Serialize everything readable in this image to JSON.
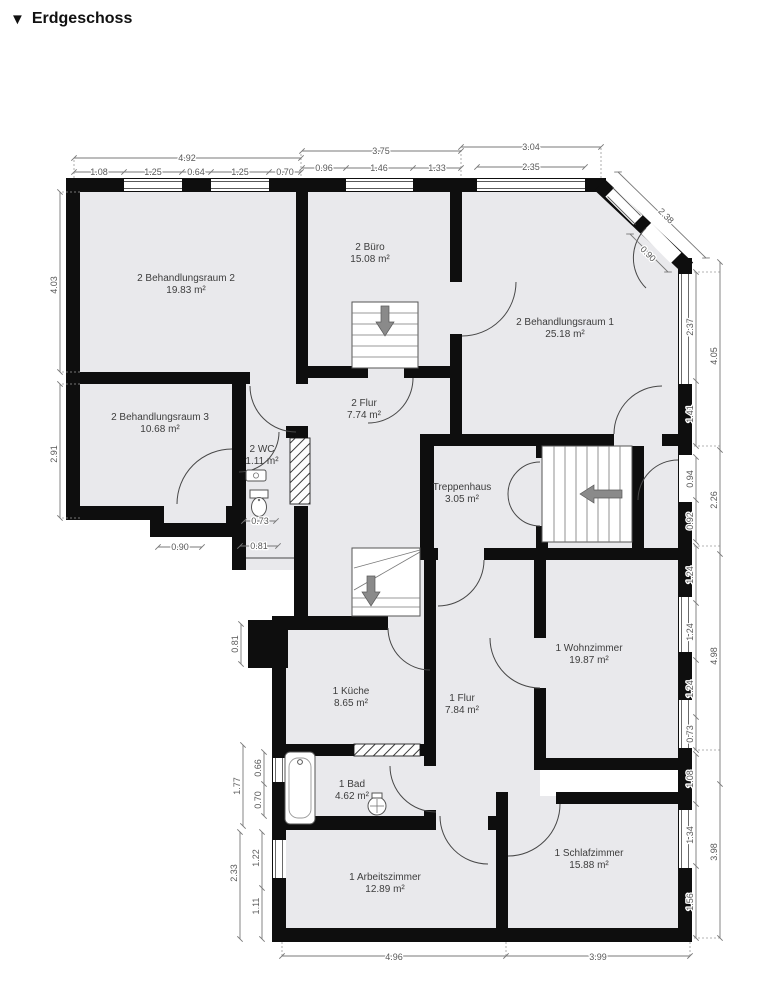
{
  "header": {
    "collapse_marker": "▼",
    "title": "Erdgeschoss"
  },
  "rooms": [
    {
      "label": "2 Behandlungsraum 2",
      "area": "19.83 m²"
    },
    {
      "label": "2 Büro",
      "area": "15.08 m²"
    },
    {
      "label": "2 Behandlungsraum 1",
      "area": "25.18 m²"
    },
    {
      "label": "2 Behandlungsraum 3",
      "area": "10.68 m²"
    },
    {
      "label": "2 Flur",
      "area": "7.74 m²"
    },
    {
      "label": "2 WC",
      "area": "1.11 m²"
    },
    {
      "label": "Treppenhaus",
      "area": "3.05 m²"
    },
    {
      "label": "1 Wohnzimmer",
      "area": "19.87 m²"
    },
    {
      "label": "1 Küche",
      "area": "8.65 m²"
    },
    {
      "label": "1 Flur",
      "area": "7.84 m²"
    },
    {
      "label": "1 Bad",
      "area": "4.62 m²"
    },
    {
      "label": "1 Arbeitszimmer",
      "area": "12.89 m²"
    },
    {
      "label": "1 Schlafzimmer",
      "area": "15.88 m²"
    }
  ],
  "dims": {
    "top": [
      "4.92",
      "1.08",
      "1.25",
      "0.64",
      "1.25",
      "0.70",
      "3.75",
      "0.96",
      "1.46",
      "1.33",
      "3.04",
      "2.35",
      "2.38",
      "0.90"
    ],
    "left": [
      "4.03",
      "2.91"
    ],
    "right_inner": [
      "2.37",
      "1.41",
      "0.94",
      "0.92",
      "1.24",
      "1.24",
      "1.24",
      "0.73",
      "1.08",
      "1.34",
      "1.56"
    ],
    "right_outer": [
      "4.05",
      "2.26",
      "4.98",
      "3.98"
    ],
    "left_lower": [
      "0.73",
      "0.81",
      "0.90",
      "0.81",
      "1.77",
      "0.66",
      "0.70",
      "2.33",
      "1.22",
      "1.11"
    ],
    "bottom": [
      "4.96",
      "3.99"
    ]
  }
}
